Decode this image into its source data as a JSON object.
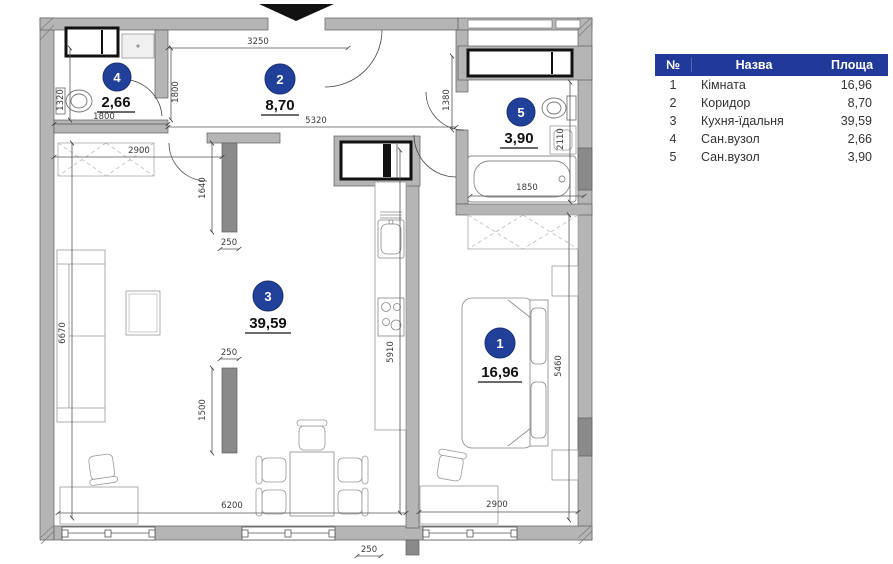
{
  "legend": {
    "headers": [
      "№",
      "Назва",
      "Площа"
    ],
    "rows": [
      {
        "num": "1",
        "name": "Кімната",
        "area": "16,96"
      },
      {
        "num": "2",
        "name": "Коридор",
        "area": "8,70"
      },
      {
        "num": "3",
        "name": "Кухня-їдальня",
        "area": "39,59"
      },
      {
        "num": "4",
        "name": "Сан.вузол",
        "area": "2,66"
      },
      {
        "num": "5",
        "name": "Сан.вузол",
        "area": "3,90"
      }
    ]
  },
  "plan": {
    "rooms": [
      {
        "num": "1",
        "area": "16,96"
      },
      {
        "num": "2",
        "area": "8,70"
      },
      {
        "num": "3",
        "area": "39,59"
      },
      {
        "num": "4",
        "area": "2,66"
      },
      {
        "num": "5",
        "area": "3,90"
      }
    ],
    "dims": {
      "top": "3250",
      "corridor": "5320",
      "r4_width": "1800",
      "r4_left": "1320",
      "r4_height": "1800",
      "wardrobe": "2900",
      "part_upper_len": "1640",
      "part_upper_th": "250",
      "part_lower_len": "1500",
      "part_lower_th": "250",
      "wall_th": "250",
      "living_left": "6670",
      "living_bottom": "6200",
      "kitchen_wall": "5910",
      "r5_door": "1380",
      "r5_right": "2110",
      "bathtub": "1850",
      "bed_wall": "5460",
      "bedroom_bottom": "2900"
    }
  },
  "colors": {
    "accent_blue": "#21409A",
    "wall_gray": "#b5b5b5",
    "wall_dark": "#8a8a8a"
  }
}
